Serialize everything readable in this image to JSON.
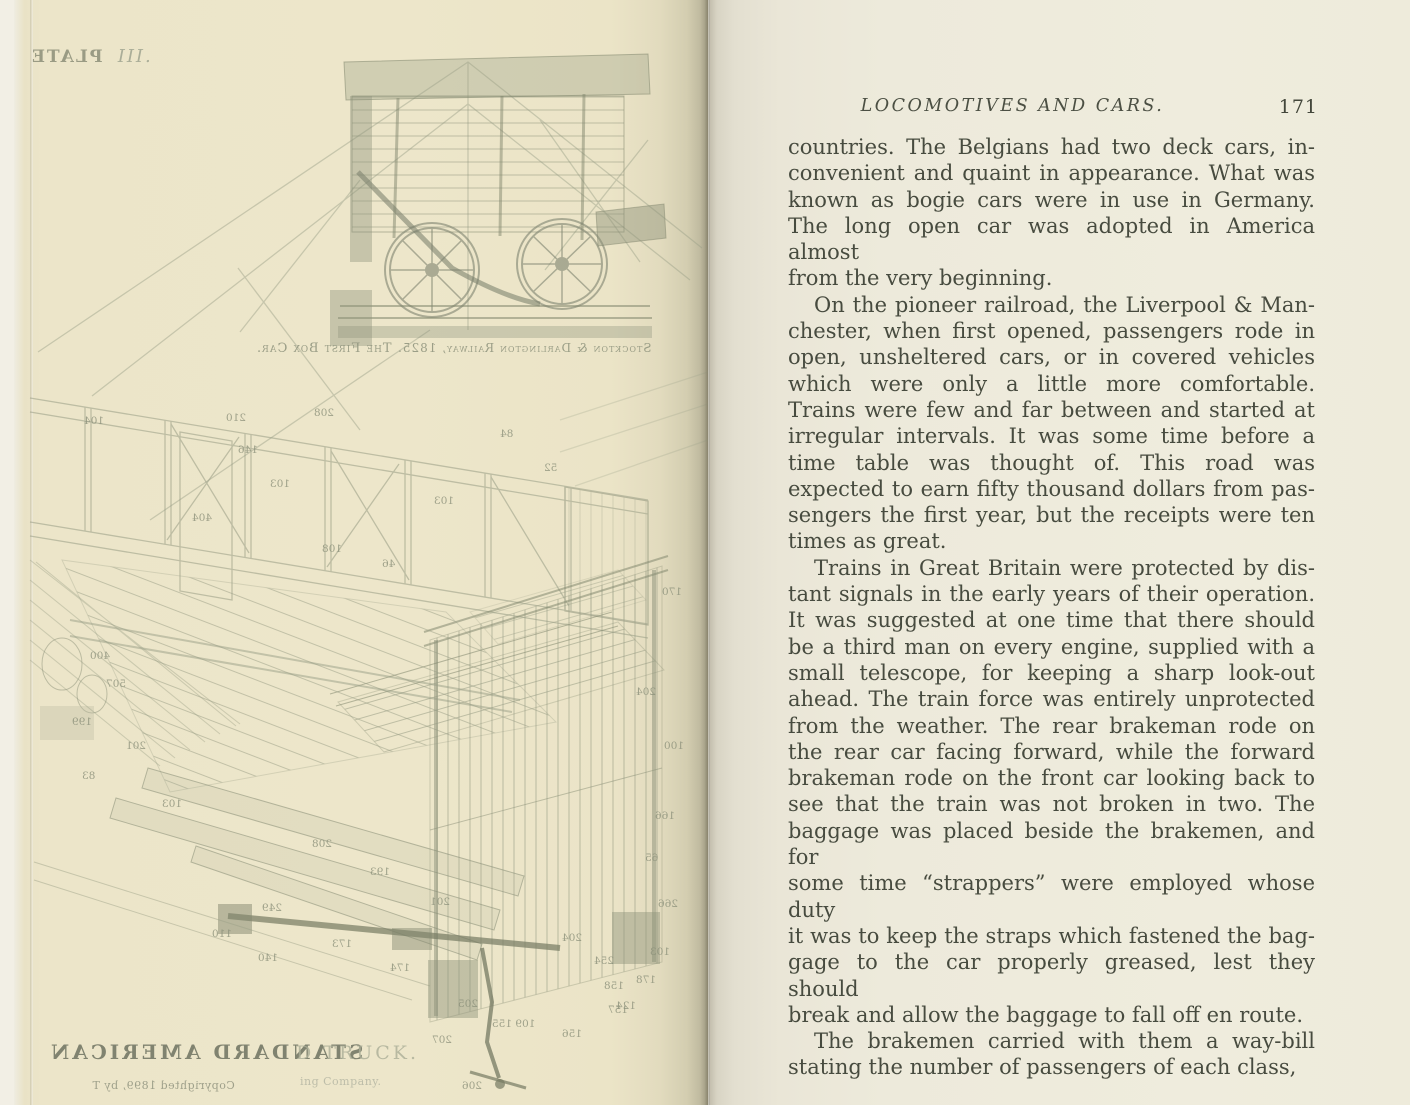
{
  "book": {
    "page_left": {
      "plate_label_mirrored": "PLATE",
      "plate_numeral": "III.",
      "figure_caption_mirrored": {
        "line1": "The First Box Car.",
        "line2": "Stockton & Darlington Railway, 1825."
      },
      "bottom_title_mirrored": "STANDARD AMERICAN",
      "bottom_title_offset_fragment": "D TRUCK.",
      "copyright_mirrored": "Copyrighted 1899, by T",
      "copyright_offset_fragment": "ing Company.",
      "part_numbers": [
        {
          "t": "210",
          "x": 212,
          "y": 412
        },
        {
          "t": "146",
          "x": 224,
          "y": 444
        },
        {
          "t": "208",
          "x": 300,
          "y": 407
        },
        {
          "t": "104",
          "x": 70,
          "y": 415
        },
        {
          "t": "103",
          "x": 256,
          "y": 478
        },
        {
          "t": "404",
          "x": 178,
          "y": 512
        },
        {
          "t": "84",
          "x": 486,
          "y": 428
        },
        {
          "t": "52",
          "x": 530,
          "y": 462
        },
        {
          "t": "103",
          "x": 420,
          "y": 495
        },
        {
          "t": "108",
          "x": 308,
          "y": 543
        },
        {
          "t": "46",
          "x": 368,
          "y": 558
        },
        {
          "t": "170",
          "x": 648,
          "y": 586
        },
        {
          "t": "204",
          "x": 622,
          "y": 686
        },
        {
          "t": "100",
          "x": 650,
          "y": 740
        },
        {
          "t": "166",
          "x": 641,
          "y": 810
        },
        {
          "t": "65",
          "x": 631,
          "y": 852
        },
        {
          "t": "266",
          "x": 644,
          "y": 898
        },
        {
          "t": "103",
          "x": 636,
          "y": 946
        },
        {
          "t": "178",
          "x": 622,
          "y": 974
        },
        {
          "t": "124",
          "x": 602,
          "y": 1000
        },
        {
          "t": "400",
          "x": 76,
          "y": 650
        },
        {
          "t": "507",
          "x": 92,
          "y": 678
        },
        {
          "t": "199",
          "x": 58,
          "y": 716
        },
        {
          "t": "201",
          "x": 112,
          "y": 740
        },
        {
          "t": "83",
          "x": 68,
          "y": 770
        },
        {
          "t": "103",
          "x": 148,
          "y": 798
        },
        {
          "t": "208",
          "x": 298,
          "y": 838
        },
        {
          "t": "193",
          "x": 356,
          "y": 866
        },
        {
          "t": "201",
          "x": 416,
          "y": 896
        },
        {
          "t": "249",
          "x": 248,
          "y": 902
        },
        {
          "t": "110",
          "x": 198,
          "y": 928
        },
        {
          "t": "173",
          "x": 318,
          "y": 938
        },
        {
          "t": "174",
          "x": 376,
          "y": 962
        },
        {
          "t": "140",
          "x": 244,
          "y": 952
        },
        {
          "t": "204",
          "x": 548,
          "y": 932
        },
        {
          "t": "254",
          "x": 580,
          "y": 955
        },
        {
          "t": "158",
          "x": 590,
          "y": 980
        },
        {
          "t": "157",
          "x": 594,
          "y": 1004
        },
        {
          "t": "156",
          "x": 548,
          "y": 1028
        },
        {
          "t": "109 155",
          "x": 478,
          "y": 1018
        },
        {
          "t": "205",
          "x": 444,
          "y": 998
        },
        {
          "t": "207",
          "x": 418,
          "y": 1034
        },
        {
          "t": "206",
          "x": 448,
          "y": 1080
        }
      ]
    },
    "page_right": {
      "running_head": "LOCOMOTIVES AND CARS.",
      "page_number": "171",
      "paragraphs": [
        {
          "indent": false,
          "lines": [
            "countries.  The Belgians had two deck cars, in-",
            "convenient and quaint in appearance.  What was",
            "known as bogie cars were in use in Germany.",
            "The long open car was adopted in America almost",
            "from the very beginning."
          ]
        },
        {
          "indent": true,
          "lines": [
            "On the pioneer railroad, the Liverpool & Man-",
            "chester, when first opened, passengers rode in",
            "open, unsheltered cars, or in covered vehicles",
            "which were only a little more comfortable.",
            "Trains were few and far between and started at",
            "irregular intervals.  It was some time before a",
            "time table was thought of.  This road was",
            "expected to earn fifty thousand dollars from pas-",
            "sengers the first year, but the receipts were ten",
            "times as great."
          ]
        },
        {
          "indent": true,
          "lines": [
            "Trains in Great Britain were protected by dis-",
            "tant signals in the early years of their operation.",
            "It was suggested at one time that there should",
            "be a third man on every engine, supplied with a",
            "small telescope, for keeping a sharp look-out",
            "ahead.  The train force was entirely unprotected",
            "from the weather.  The rear brakeman rode on",
            "the rear car facing forward, while the forward",
            "brakeman rode on the front car looking back to",
            "see that the train was not broken in two.  The",
            "baggage was placed beside the brakemen, and for",
            "some time “strappers” were employed whose duty",
            "it was to keep the straps which fastened the bag-",
            "gage to the car properly greased, lest they should",
            "break and allow the baggage to fall off en route."
          ]
        },
        {
          "indent": true,
          "lines": [
            "The brakemen carried with them a way-bill",
            "stating the number of passengers of each class,"
          ]
        }
      ]
    },
    "colors": {
      "left_paper": "#ede6ca",
      "right_paper": "#eeeadb",
      "ink": "#474b3f",
      "ghost_ink": "#989d85"
    }
  }
}
